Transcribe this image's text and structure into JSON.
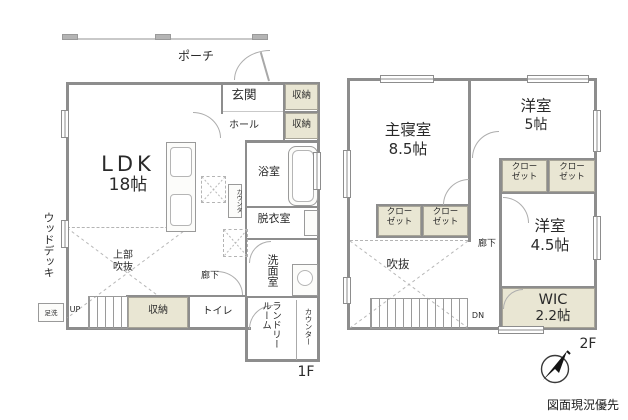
{
  "disclaimer": "図面現況優先",
  "floor1": {
    "label": "1F",
    "porch": "ポーチ",
    "entrance": "玄関",
    "entrance_storage": "収納",
    "hall": "ホール",
    "hall_storage": "収納",
    "ldk_name": "LDK",
    "ldk_size": "18帖",
    "bath": "浴室",
    "dressing_room": "脱衣室",
    "washroom": "洗面室",
    "kitchen_counter": "カウンタ",
    "upper_void": "上部\n吹抜",
    "corridor": "廊下",
    "storage": "収納",
    "toilet": "トイレ",
    "laundry_room": "ランドリールーム",
    "counter": "カウンター",
    "up": "UP",
    "wood_deck": "ウッドデッキ",
    "foot_wash": "足洗"
  },
  "floor2": {
    "label": "2F",
    "master_bedroom_name": "主寝室",
    "master_bedroom_size": "8.5帖",
    "bedroom5_name": "洋室",
    "bedroom5_size": "5帖",
    "closet": "クロー\nゼット",
    "bedroom45_name": "洋室",
    "bedroom45_size": "4.5帖",
    "wic_name": "WIC",
    "wic_size": "2.2帖",
    "void": "吹抜",
    "corridor": "廊下",
    "down": "DN"
  }
}
